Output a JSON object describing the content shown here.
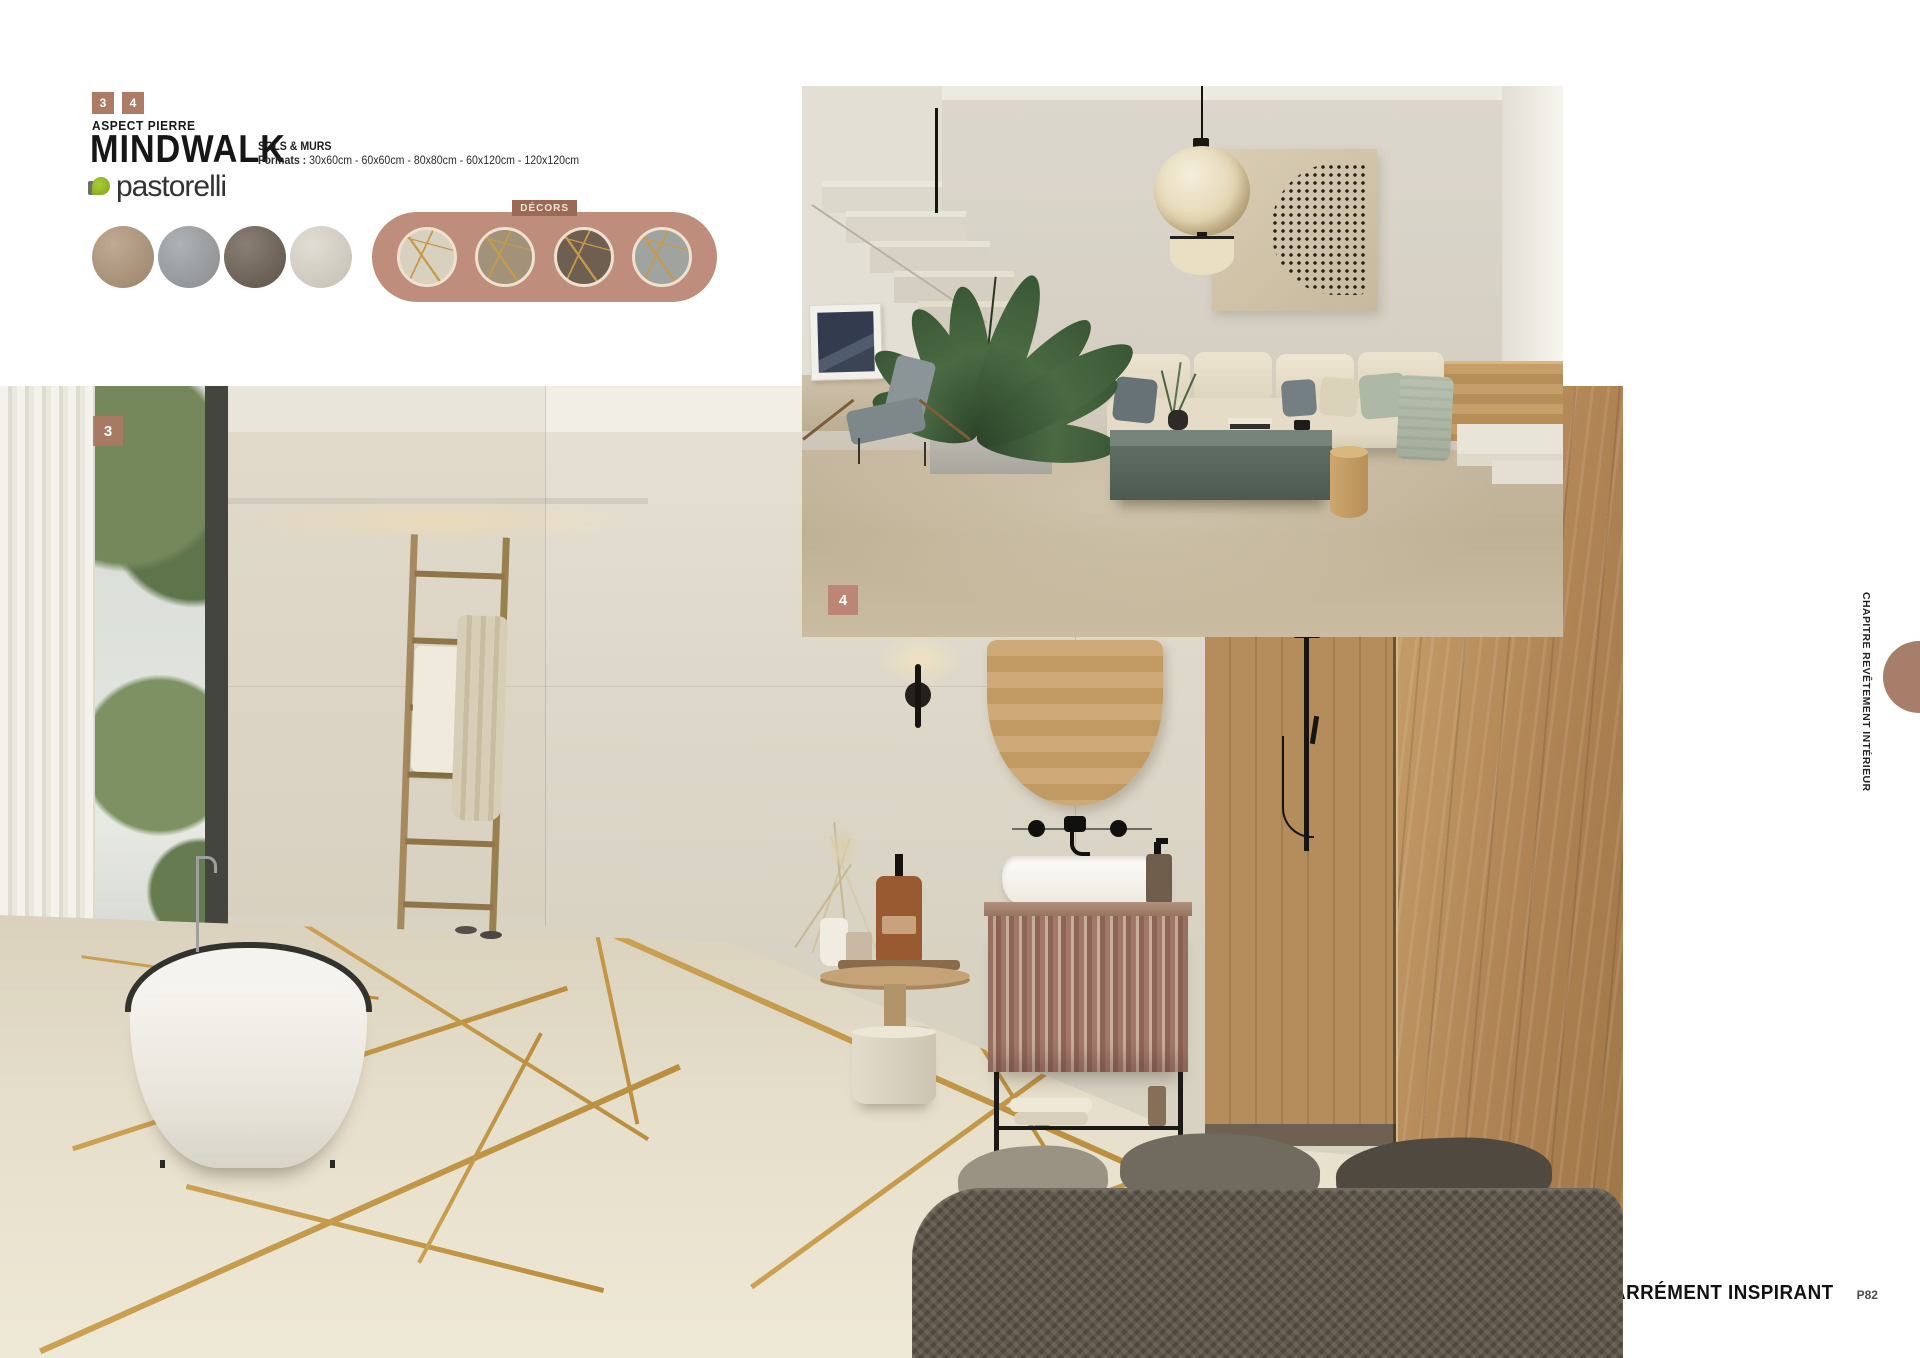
{
  "header": {
    "ref_badges": [
      "3",
      "4"
    ],
    "category": "ASPECT PIERRE",
    "collection": "MINDWALK",
    "brand": "pastorelli",
    "usage": "SOLS & MURS",
    "formats_label": "Formats :",
    "formats_value": "30x60cm - 60x60cm - 80x80cm - 60x120cm - 120x120cm",
    "decors_label": "DÉCORS",
    "badge_color": "#ad7c66",
    "decor_group_color": "#bf8d7c",
    "decor_badge_color": "#9b6a57",
    "swatches": [
      {
        "name": "stone-beige",
        "color": "#b1977c"
      },
      {
        "name": "stone-grey",
        "color": "#9da1a4"
      },
      {
        "name": "stone-taupe",
        "color": "#6f6356"
      },
      {
        "name": "stone-white",
        "color": "#dcd6cb"
      }
    ],
    "decor_swatches": [
      {
        "name": "decor-white-gold",
        "color": "#d8d1c0"
      },
      {
        "name": "decor-beige-gold",
        "color": "#a3927a"
      },
      {
        "name": "decor-taupe-gold",
        "color": "#6e5f50"
      },
      {
        "name": "decor-grey-gold",
        "color": "#9fa4a0"
      }
    ]
  },
  "photos": {
    "living_room": {
      "ref": "4"
    },
    "bathroom": {
      "ref": "3"
    }
  },
  "sidebar": {
    "chapter_label": "CHAPITRE REVÊTEMENT INTÉRIEUR"
  },
  "footer": {
    "brand_logo": "CARRÉMENT INSPIRANT",
    "page_ref": "P82"
  }
}
